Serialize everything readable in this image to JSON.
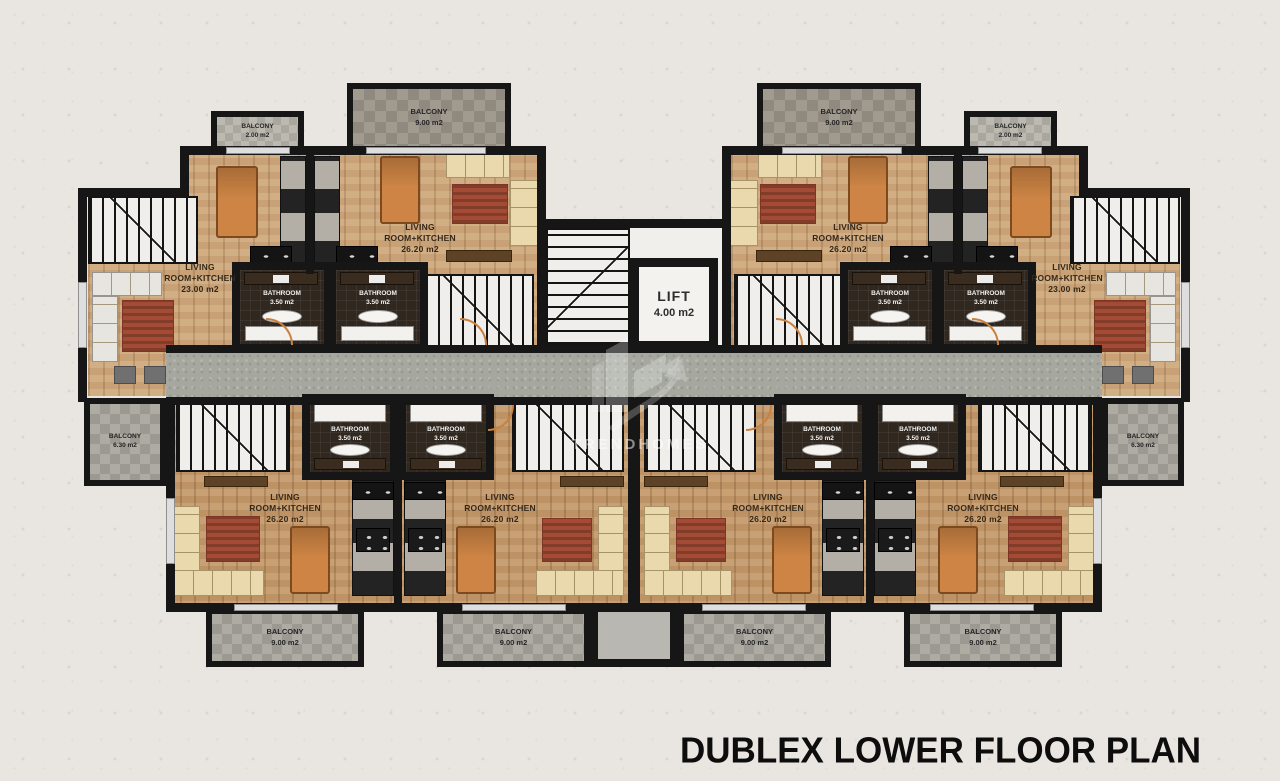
{
  "title": "DUBLEX LOWER FLOOR PLAN",
  "watermark": "TRENDHOMES",
  "lift": {
    "label": "LIFT",
    "area": "4.00 m2"
  },
  "room_label": {
    "line1": "LIVING",
    "line2": "ROOM+KITCHEN"
  },
  "apartments": {
    "a1": {
      "area": "23.00 m2"
    },
    "a2": {
      "area": "26.20 m2"
    },
    "a3": {
      "area": "26.20 m2"
    },
    "a4": {
      "area": "23.00 m2"
    },
    "b1": {
      "area": "26.20 m2"
    },
    "b2": {
      "area": "26.20 m2"
    },
    "b3": {
      "area": "26.20 m2"
    },
    "b4": {
      "area": "26.20 m2"
    }
  },
  "bathroom": {
    "label": "BATHROOM",
    "area": "3.50 m2"
  },
  "balcony_types": {
    "small": {
      "label": "BALCONY",
      "area": "2.00 m2"
    },
    "large": {
      "label": "BALCONY",
      "area": "9.00 m2"
    },
    "side": {
      "label": "BALCONY",
      "area": "6.30 m2"
    }
  },
  "colors": {
    "wall": "#161616",
    "wood_upper": "#cfa87c",
    "wood_lower": "#c59a6c",
    "tile_dark": "#968f85",
    "tile_light": "#b2afa7",
    "corridor": "#a6a8a0",
    "bathroom_tile": "#30271f",
    "table_wood": "#cd8444",
    "rug": "#a34b35",
    "sofa": "#ead9ad",
    "door_arc": "#c9813e",
    "title_color": "#0d0d0d",
    "paper": "#e9e6e2"
  }
}
